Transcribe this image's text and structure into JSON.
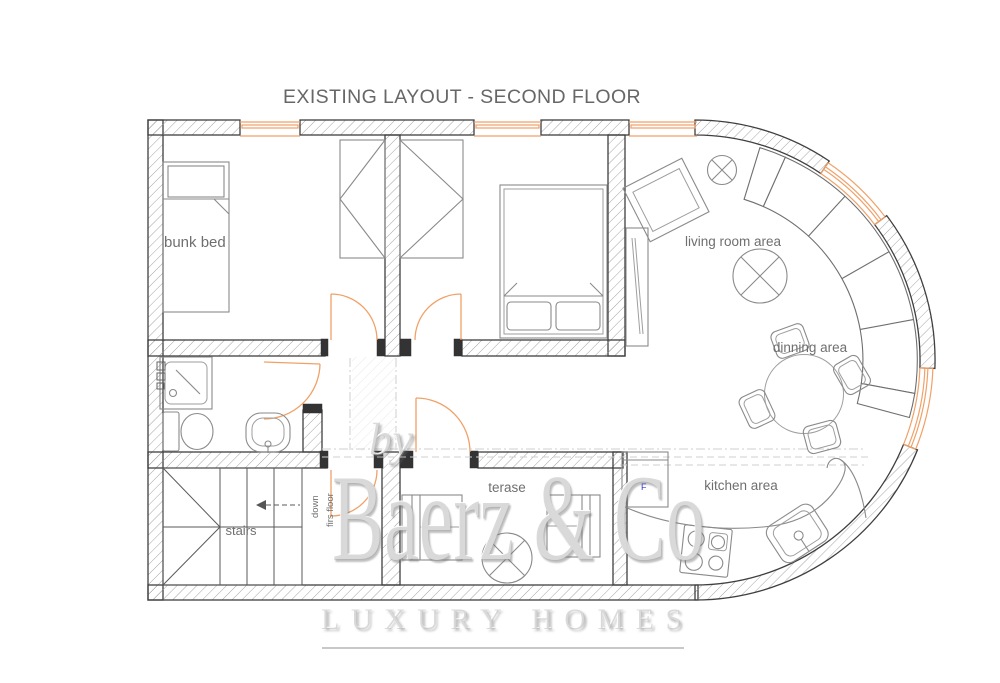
{
  "title": "EXISTING LAYOUT - SECOND FLOOR",
  "floor_plan": {
    "rooms": {
      "bunk_bed": "bunk bed",
      "living_room": "living room area",
      "dining": "dinning area",
      "kitchen": "kitchen area",
      "terrace": "terase",
      "stairs": "stairs",
      "stairs_note_line1": "down",
      "stairs_note_line2": "firs floor"
    },
    "appliance_marks": {
      "fridge": "F"
    }
  },
  "watermark": {
    "prefix": "by",
    "brand": "Baerz & Co",
    "tagline": "LUXURY HOMES"
  },
  "colors": {
    "walls": "#3f3f3f",
    "window_door_accent": "#f0a168",
    "furniture": "#8a8a8a",
    "labels": "#6f6f6f",
    "fridge_mark_blue": "#3434d6",
    "watermark_gray": "#bdbdbd"
  }
}
